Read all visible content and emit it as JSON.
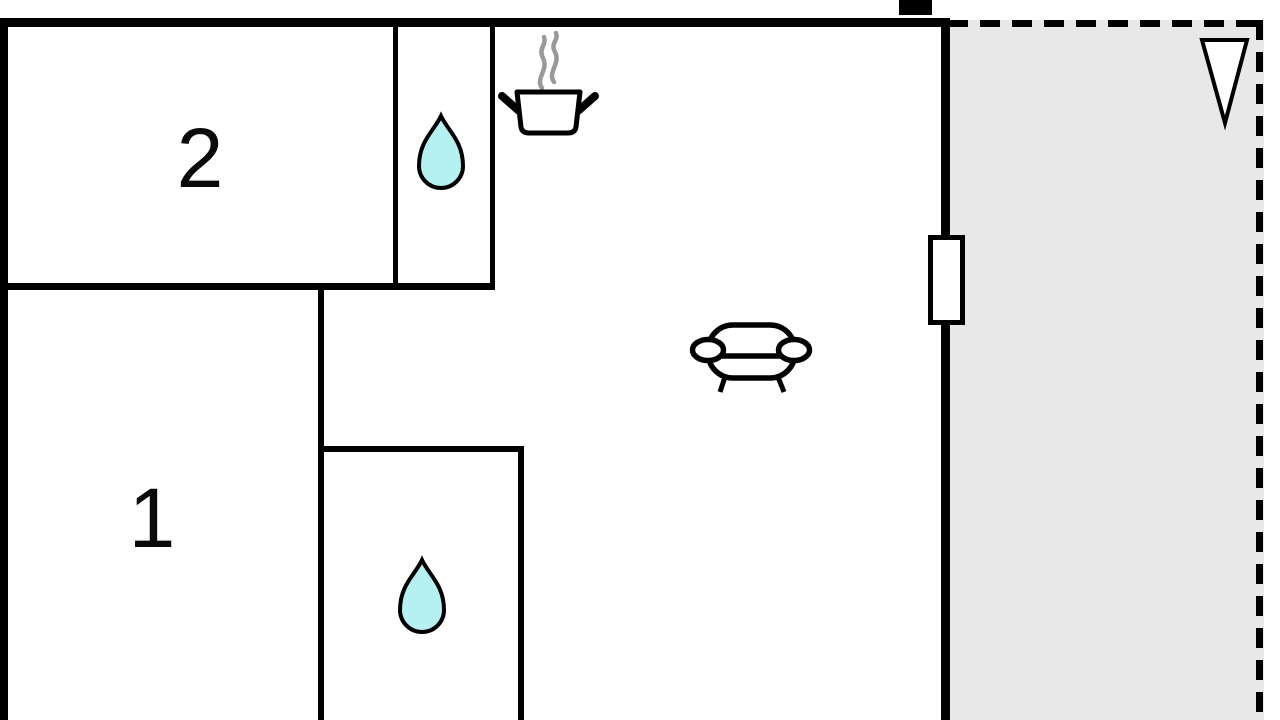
{
  "plan": {
    "type": "apartment-floor-plan",
    "rooms": [
      {
        "label": "2"
      },
      {
        "label": "1"
      }
    ],
    "icons": {
      "bath_top": "water-drop-icon",
      "bath_bottom": "water-drop-icon",
      "kitchen": "cooking-pot-icon",
      "kitchen_steam": "steam-icon",
      "living": "sofa-icon",
      "orientation": "north-arrow-icon",
      "opening": "window-marker",
      "flue": "chimney-marker"
    }
  },
  "colors": {
    "wall": "#000000",
    "background": "#ffffff",
    "terrace_fill": "#e8e8e8",
    "water": "#b5f1f1",
    "steam": "#999999",
    "label": "#0a0a0a"
  }
}
